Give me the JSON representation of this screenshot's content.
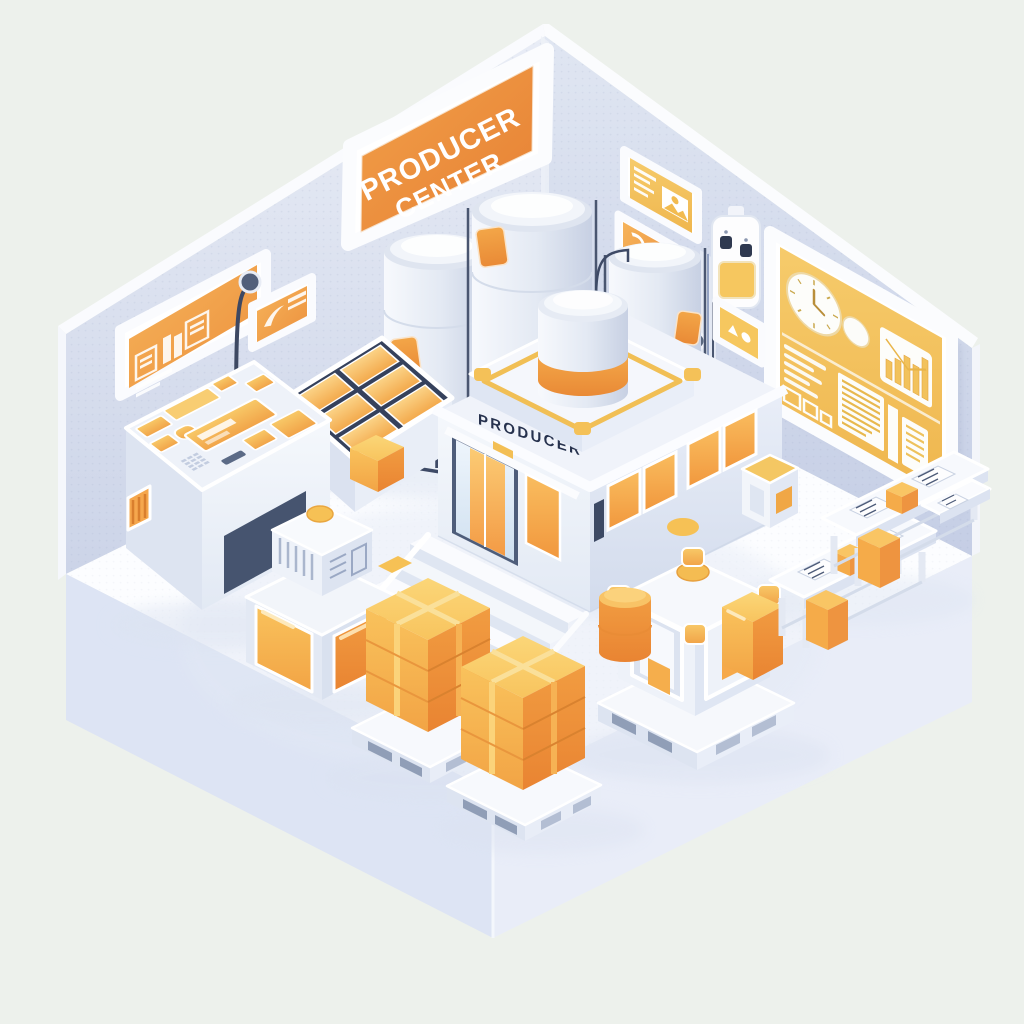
{
  "meta": {
    "type": "isometric-illustration",
    "subject": "Producer Center facility room with equipment, tanks, pallets and dashboards",
    "canvas": {
      "width": 1024,
      "height": 1024
    }
  },
  "palette": {
    "background": "#EDF1EC",
    "wall": "#D7DEEC",
    "wall_light": "#E9EDF6",
    "floor": "#FCFDFF",
    "platform_side": "#DDE4F4",
    "sign_orange": "#EC8C3C",
    "accent_orange": "#F09C44",
    "window_orange": "#F6AC4B",
    "box_orange": "#F4A847",
    "panel_yellow": "#F4C763",
    "trim_yellow": "#F3BF55",
    "button_yellow": "#F6C155",
    "outline_white": "#FFFFFF",
    "detail_navy": "#3E4A66",
    "text_dark": "#27324E",
    "text_light": "#FFFFFF"
  },
  "signs": {
    "main_sign": {
      "line1": "PRODUCER",
      "line2": "CENTER"
    },
    "building_label": "PRODUCER"
  },
  "scene": {
    "objects": [
      {
        "name": "producer-center-sign",
        "desc": "Large orange wall sign reading PRODUCER CENTER"
      },
      {
        "name": "info-sign",
        "desc": "Orange wall panel with abstract data glyphs"
      },
      {
        "name": "pole-sign",
        "desc": "Small orange sign on a curved wall pole with a round knob"
      },
      {
        "name": "control-console",
        "desc": "White kiosk console with orange screens, buttons and keypad"
      },
      {
        "name": "wall-barcode",
        "desc": "Small striped orange marker on the wall"
      },
      {
        "name": "solar-panel-rack",
        "desc": "Sloped rack holding six orange textured panels with boxes at its base"
      },
      {
        "name": "storage-tank-left",
        "desc": "White storage tank with orange label and support legs"
      },
      {
        "name": "storage-tank-center",
        "desc": "Tall white storage tank with orange label"
      },
      {
        "name": "storage-tank-right",
        "desc": "White storage tank with orange label and pipe"
      },
      {
        "name": "main-building",
        "desc": "White flat-roof building labeled PRODUCER with glass entrance and orange windows"
      },
      {
        "name": "roof-platform",
        "desc": "Rooftop platform with yellow trim and corner markers"
      },
      {
        "name": "roof-cylinder",
        "desc": "White rooftop cylinder with orange band"
      },
      {
        "name": "entrance-stairs",
        "desc": "Wide white staircase descending from the entrance"
      },
      {
        "name": "crate-machine",
        "desc": "Vented white unit with yellow top button on a base with two orange cabinet panels"
      },
      {
        "name": "pallet-with-boxes-1",
        "desc": "Shipping pallet stacked with taped orange boxes"
      },
      {
        "name": "pallet-with-boxes-2",
        "desc": "Shipping pallet stacked with taped orange boxes"
      },
      {
        "name": "caged-machine",
        "desc": "White frame machine on a pallet with yellow corner guards and top button"
      },
      {
        "name": "supply-drum",
        "desc": "Orange drum beside the caged machine"
      },
      {
        "name": "supply-box",
        "desc": "Orange cube box beside the caged machine"
      },
      {
        "name": "workbench-1",
        "desc": "White bench with paperwork, small orange box on top and one below"
      },
      {
        "name": "workbench-2",
        "desc": "White bench with paperwork and orange boxes"
      },
      {
        "name": "side-table",
        "desc": "Small white stand with a document"
      },
      {
        "name": "dashboard-panel",
        "desc": "Large yellow wall dashboard with analog clock, gauge, bar chart, text lines and data tables"
      },
      {
        "name": "wall-panel-top",
        "desc": "Small yellow wall information panel with text lines and picture"
      },
      {
        "name": "wall-panel-mid",
        "desc": "Small yellow wall information panel with glyph"
      },
      {
        "name": "thermostat-device",
        "desc": "White wall controller with two dark buttons and yellow display"
      },
      {
        "name": "corner-sign",
        "desc": "Small yellow pictogram sign near the wall corner"
      },
      {
        "name": "corner-conduit",
        "desc": "Vertical conduit strip where the walls meet"
      },
      {
        "name": "utility-cube",
        "desc": "Small white cube unit with yellow top near the right wall"
      },
      {
        "name": "floor-markers",
        "desc": "Small yellow tiles on the floor"
      }
    ],
    "dashboard_widgets": [
      "analog-clock",
      "round-gauge",
      "bar-chart",
      "text-lines",
      "data-table",
      "checkbox-squares"
    ]
  }
}
